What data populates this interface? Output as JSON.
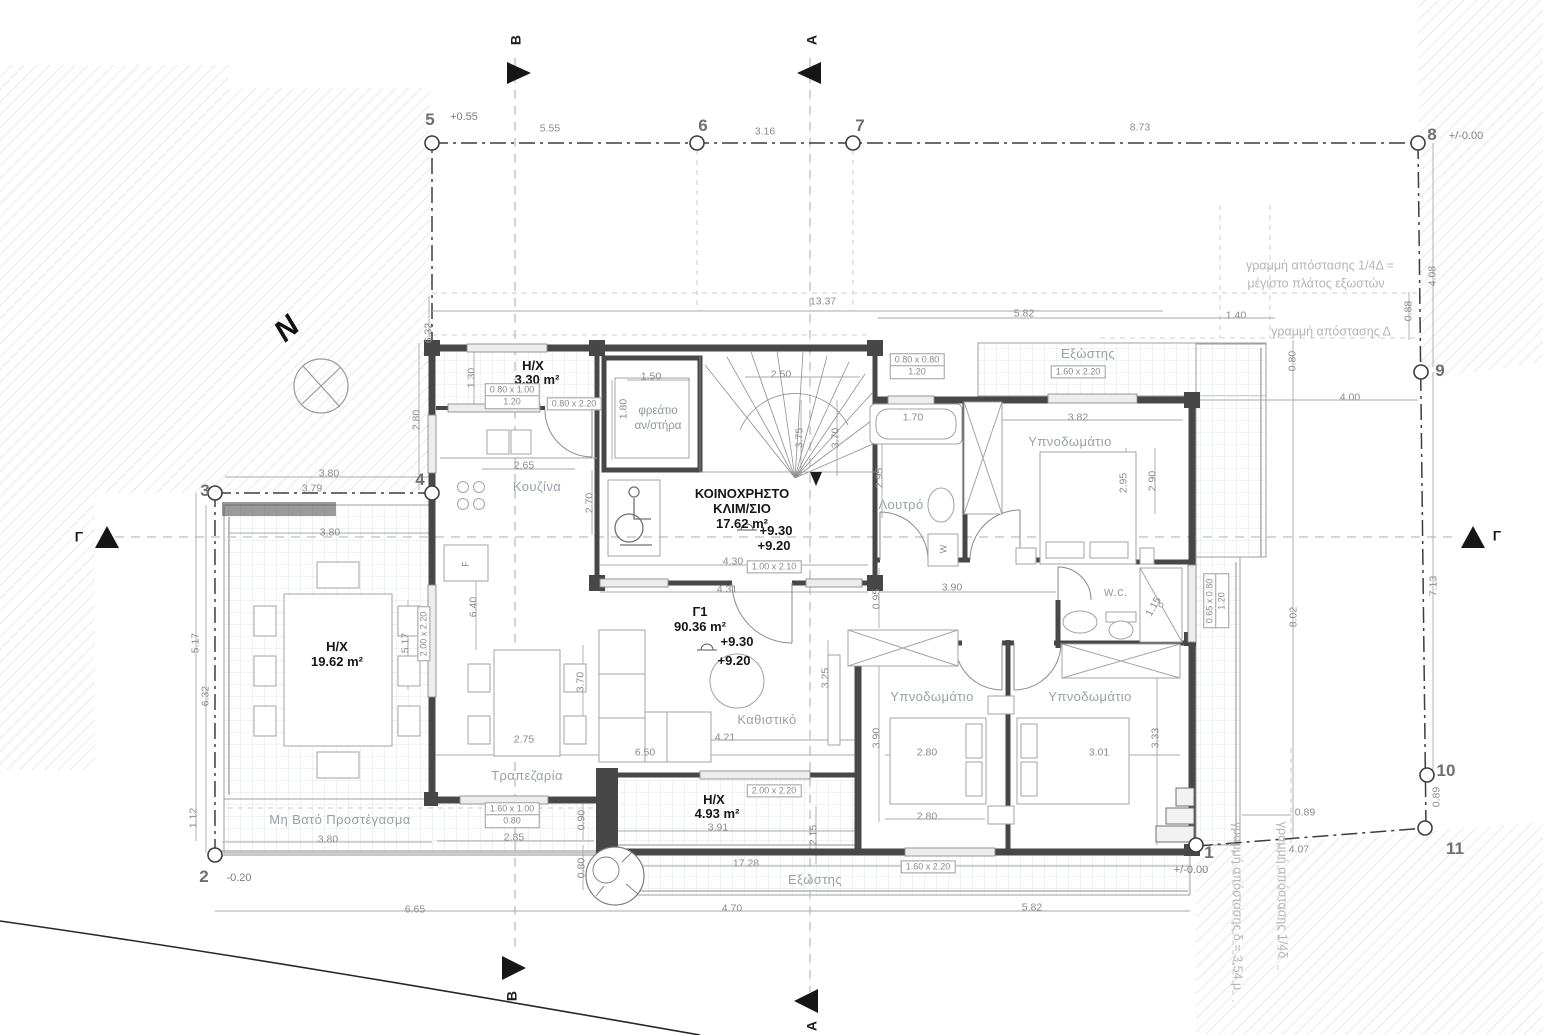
{
  "drawing_type": "floor-plan",
  "labels": [
    {
      "t": "5",
      "x": 430,
      "y": 120,
      "cls": "pt",
      "n": "grid-point-5"
    },
    {
      "t": "6",
      "x": 703,
      "y": 126,
      "cls": "pt",
      "n": "grid-point-6"
    },
    {
      "t": "7",
      "x": 860,
      "y": 126,
      "cls": "pt",
      "n": "grid-point-7"
    },
    {
      "t": "8",
      "x": 1432,
      "y": 135,
      "cls": "pt",
      "n": "grid-point-8"
    },
    {
      "t": "9",
      "x": 1440,
      "y": 371,
      "cls": "pt",
      "n": "grid-point-9"
    },
    {
      "t": "10",
      "x": 1446,
      "y": 771,
      "cls": "pt",
      "n": "grid-point-10"
    },
    {
      "t": "11",
      "x": 1455,
      "y": 849,
      "cls": "pt",
      "n": "grid-point-11"
    },
    {
      "t": "1",
      "x": 1209,
      "y": 853,
      "cls": "pt",
      "n": "grid-point-1"
    },
    {
      "t": "2",
      "x": 204,
      "y": 877,
      "cls": "pt",
      "n": "grid-point-2"
    },
    {
      "t": "3",
      "x": 205,
      "y": 491,
      "cls": "pt",
      "n": "grid-point-3"
    },
    {
      "t": "4",
      "x": 420,
      "y": 480,
      "cls": "pt",
      "n": "grid-point-4"
    },
    {
      "t": "+0.55",
      "x": 464,
      "y": 118,
      "cls": "lvl",
      "n": "level-label"
    },
    {
      "t": "+/-0.00",
      "x": 1466,
      "y": 137,
      "cls": "lvl",
      "n": "level-label"
    },
    {
      "t": "-0.20",
      "x": 239,
      "y": 879,
      "cls": "lvl",
      "n": "level-label"
    },
    {
      "t": "+/-0.00",
      "x": 1191,
      "y": 871,
      "cls": "lvl",
      "n": "level-label"
    },
    {
      "t": "5.55",
      "x": 550,
      "y": 129,
      "cls": "dim"
    },
    {
      "t": "3.16",
      "x": 765,
      "y": 132,
      "cls": "dim"
    },
    {
      "t": "8.73",
      "x": 1140,
      "y": 128,
      "cls": "dim"
    },
    {
      "t": "13.37",
      "x": 823,
      "y": 302,
      "cls": "dim"
    },
    {
      "t": "5.82",
      "x": 1024,
      "y": 314,
      "cls": "dim"
    },
    {
      "t": "1.40",
      "x": 1236,
      "y": 316,
      "cls": "dim"
    },
    {
      "t": "4.08",
      "x": 1433,
      "y": 276,
      "r": -90,
      "cls": "dim"
    },
    {
      "t": "0.88",
      "x": 1409,
      "y": 311,
      "r": -90,
      "cls": "dim"
    },
    {
      "t": "0.80",
      "x": 1293,
      "y": 361,
      "r": -90,
      "cls": "dim"
    },
    {
      "t": "4.00",
      "x": 1350,
      "y": 398,
      "cls": "dim"
    },
    {
      "t": "8.02",
      "x": 1294,
      "y": 617,
      "r": -90,
      "cls": "dim"
    },
    {
      "t": "7.13",
      "x": 1434,
      "y": 586,
      "r": -90,
      "cls": "dim"
    },
    {
      "t": "0.89",
      "x": 1437,
      "y": 797,
      "r": -90,
      "cls": "dim"
    },
    {
      "t": "0.89",
      "x": 1305,
      "y": 813,
      "cls": "dim"
    },
    {
      "t": "4.07",
      "x": 1299,
      "y": 850,
      "cls": "dim"
    },
    {
      "t": "6.32",
      "x": 429,
      "y": 333,
      "r": -90,
      "cls": "dim"
    },
    {
      "t": "2.80",
      "x": 417,
      "y": 420,
      "r": -90,
      "cls": "dim"
    },
    {
      "t": "1.30",
      "x": 472,
      "y": 378,
      "r": -90,
      "cls": "dim"
    },
    {
      "t": "3.80",
      "x": 329,
      "y": 474,
      "cls": "dim"
    },
    {
      "t": "3.79",
      "x": 312,
      "y": 489,
      "cls": "dim"
    },
    {
      "t": "3.80",
      "x": 330,
      "y": 533,
      "cls": "dim"
    },
    {
      "t": "5.17",
      "x": 196,
      "y": 643,
      "r": -90,
      "cls": "dim"
    },
    {
      "t": "6.32",
      "x": 206,
      "y": 696,
      "r": -90,
      "cls": "dim"
    },
    {
      "t": "1.12",
      "x": 194,
      "y": 818,
      "r": -90,
      "cls": "dim"
    },
    {
      "t": "5.17",
      "x": 406,
      "y": 643,
      "r": -90,
      "cls": "dim"
    },
    {
      "t": "6.40",
      "x": 474,
      "y": 607,
      "r": -90,
      "cls": "dim"
    },
    {
      "t": "2.65",
      "x": 524,
      "y": 466,
      "cls": "dim"
    },
    {
      "t": "2.70",
      "x": 590,
      "y": 503,
      "r": -90,
      "cls": "dim"
    },
    {
      "t": "1.50",
      "x": 651,
      "y": 377,
      "cls": "dim"
    },
    {
      "t": "2.50",
      "x": 781,
      "y": 375,
      "cls": "dim"
    },
    {
      "t": "1.80",
      "x": 624,
      "y": 409,
      "r": -90,
      "cls": "dim"
    },
    {
      "t": "3.75",
      "x": 800,
      "y": 438,
      "r": -90,
      "cls": "dim"
    },
    {
      "t": "3.70",
      "x": 836,
      "y": 438,
      "r": -90,
      "cls": "dim"
    },
    {
      "t": "4.30",
      "x": 733,
      "y": 562,
      "cls": "dim"
    },
    {
      "t": "4.31",
      "x": 727,
      "y": 590,
      "cls": "dim"
    },
    {
      "t": "1.70",
      "x": 913,
      "y": 418,
      "cls": "dim"
    },
    {
      "t": "2.95",
      "x": 880,
      "y": 478,
      "r": -90,
      "cls": "dim"
    },
    {
      "t": "3.82",
      "x": 1078,
      "y": 418,
      "cls": "dim"
    },
    {
      "t": "2.95",
      "x": 1124,
      "y": 483,
      "r": -90,
      "cls": "dim"
    },
    {
      "t": "2.90",
      "x": 1153,
      "y": 481,
      "r": -90,
      "cls": "dim"
    },
    {
      "t": "0.95",
      "x": 877,
      "y": 599,
      "r": -90,
      "cls": "dim"
    },
    {
      "t": "3.90",
      "x": 952,
      "y": 588,
      "cls": "dim"
    },
    {
      "t": "1.15",
      "x": 1154,
      "y": 607,
      "r": -60,
      "cls": "dim"
    },
    {
      "t": "2.75",
      "x": 524,
      "y": 740,
      "cls": "dim"
    },
    {
      "t": "3.70",
      "x": 581,
      "y": 682,
      "r": -90,
      "cls": "dim"
    },
    {
      "t": "6.50",
      "x": 645,
      "y": 753,
      "cls": "dim"
    },
    {
      "t": "4.21",
      "x": 725,
      "y": 738,
      "cls": "dim"
    },
    {
      "t": "3.25",
      "x": 826,
      "y": 678,
      "r": -90,
      "cls": "dim"
    },
    {
      "t": "3.90",
      "x": 877,
      "y": 738,
      "r": -90,
      "cls": "dim"
    },
    {
      "t": "2.80",
      "x": 927,
      "y": 753,
      "cls": "dim"
    },
    {
      "t": "3.01",
      "x": 1099,
      "y": 753,
      "cls": "dim"
    },
    {
      "t": "3.33",
      "x": 1156,
      "y": 738,
      "r": -90,
      "cls": "dim"
    },
    {
      "t": "2.80",
      "x": 927,
      "y": 817,
      "cls": "dim"
    },
    {
      "t": "2.85",
      "x": 514,
      "y": 838,
      "cls": "dim"
    },
    {
      "t": "0.90",
      "x": 582,
      "y": 820,
      "r": -90,
      "cls": "dim"
    },
    {
      "t": "0.80",
      "x": 582,
      "y": 868,
      "r": -90,
      "cls": "dim"
    },
    {
      "t": "3.91",
      "x": 718,
      "y": 828,
      "cls": "dim"
    },
    {
      "t": "2.15",
      "x": 814,
      "y": 835,
      "r": -90,
      "cls": "dim"
    },
    {
      "t": "17.28",
      "x": 746,
      "y": 864,
      "cls": "dim"
    },
    {
      "t": "3.80",
      "x": 328,
      "y": 840,
      "cls": "dim"
    },
    {
      "t": "6.65",
      "x": 415,
      "y": 910,
      "cls": "dim"
    },
    {
      "t": "4.70",
      "x": 732,
      "y": 909,
      "cls": "dim"
    },
    {
      "t": "5.82",
      "x": 1032,
      "y": 908,
      "cls": "dim"
    },
    {
      "t": "Κουζίνα",
      "x": 537,
      "y": 487,
      "cls": "room",
      "n": "room-label-kitchen"
    },
    {
      "t": "Λουτρό",
      "x": 901,
      "y": 505,
      "cls": "room",
      "n": "room-label-bathroom"
    },
    {
      "t": "Υπνοδωμάτιο",
      "x": 1070,
      "y": 442,
      "cls": "room",
      "n": "room-label-bedroom-1"
    },
    {
      "t": "Καθιστικό",
      "x": 767,
      "y": 720,
      "cls": "room",
      "n": "room-label-living"
    },
    {
      "t": "Τραπεζαρία",
      "x": 527,
      "y": 776,
      "cls": "room",
      "n": "room-label-dining"
    },
    {
      "t": "Υπνοδωμάτιο",
      "x": 932,
      "y": 697,
      "cls": "room",
      "n": "room-label-bedroom-2"
    },
    {
      "t": "Υπνοδωμάτιο",
      "x": 1090,
      "y": 697,
      "cls": "room",
      "n": "room-label-bedroom-3"
    },
    {
      "t": "w.c.",
      "x": 1116,
      "y": 592,
      "cls": "room",
      "n": "room-label-wc"
    },
    {
      "t": "Εξώστης",
      "x": 1088,
      "y": 354,
      "cls": "room",
      "n": "room-label-balcony-top"
    },
    {
      "t": "Εξώστης",
      "x": 815,
      "y": 880,
      "cls": "room",
      "n": "room-label-balcony-bottom"
    },
    {
      "t": "Μη Βατό Προστέγασμα",
      "x": 340,
      "y": 820,
      "cls": "room",
      "n": "room-label-canopy"
    },
    {
      "t": "φρεάτιο",
      "x": 658,
      "y": 411,
      "cls": "roomsm",
      "n": "room-label-elevator-shaft"
    },
    {
      "t": "αν/στήρα",
      "x": 658,
      "y": 426,
      "cls": "roomsm",
      "n": "room-label-elevator-shaft"
    },
    {
      "t": "H/X",
      "x": 533,
      "y": 366,
      "cls": "bold",
      "n": "area-label"
    },
    {
      "t": "3.30 m²",
      "x": 537,
      "y": 380,
      "cls": "bold",
      "n": "area-label"
    },
    {
      "t": "H/X",
      "x": 337,
      "y": 647,
      "cls": "bold",
      "n": "area-label"
    },
    {
      "t": "19.62 m²",
      "x": 337,
      "y": 662,
      "cls": "bold",
      "n": "area-label"
    },
    {
      "t": "ΚΟΙΝΟΧΡΗΣΤΟ",
      "x": 742,
      "y": 494,
      "cls": "bold",
      "n": "area-label-common-stair"
    },
    {
      "t": "ΚΛΙΜ/ΣΙΟ",
      "x": 742,
      "y": 509,
      "cls": "bold",
      "n": "area-label-common-stair"
    },
    {
      "t": "17.62 m²",
      "x": 742,
      "y": 524,
      "cls": "bold",
      "n": "area-label-common-stair"
    },
    {
      "t": "Γ1",
      "x": 700,
      "y": 612,
      "cls": "bold",
      "n": "area-label-apartment"
    },
    {
      "t": "90.36 m²",
      "x": 700,
      "y": 627,
      "cls": "bold",
      "n": "area-label-apartment"
    },
    {
      "t": "H/X",
      "x": 714,
      "y": 800,
      "cls": "bold",
      "n": "area-label"
    },
    {
      "t": "4.93 m²",
      "x": 717,
      "y": 814,
      "cls": "bold",
      "n": "area-label"
    },
    {
      "t": "+9.30",
      "x": 776,
      "y": 531,
      "cls": "bold",
      "n": "level-label"
    },
    {
      "t": "+9.20",
      "x": 774,
      "y": 546,
      "cls": "bold",
      "n": "level-label"
    },
    {
      "t": "+9.30",
      "x": 737,
      "y": 642,
      "cls": "bold",
      "n": "level-label"
    },
    {
      "t": "+9.20",
      "x": 734,
      "y": 661,
      "cls": "bold",
      "n": "level-label"
    },
    {
      "t": "γραμμή απόστασης 1/4Δ =",
      "x": 1320,
      "y": 266,
      "cls": "setb",
      "n": "setback-note"
    },
    {
      "t": "μέγιστο πλάτος εξωστών",
      "x": 1316,
      "y": 284,
      "cls": "setb",
      "n": "setback-note"
    },
    {
      "t": "γραμμή απόστασης Δ",
      "x": 1331,
      "y": 332,
      "cls": "setb",
      "n": "setback-note"
    },
    {
      "t": "γραμμή απόστασης δ = 3,54 μ",
      "x": 1237,
      "y": 906,
      "r": 90,
      "cls": "setb",
      "n": "setback-note"
    },
    {
      "t": "γραμμή απόστασης 1/4δ",
      "x": 1282,
      "y": 890,
      "r": 90,
      "cls": "setb",
      "n": "setback-note"
    },
    {
      "t": "B",
      "x": 516,
      "y": 40,
      "r": -90,
      "cls": "sec",
      "n": "section-marker-b-top"
    },
    {
      "t": "A",
      "x": 812,
      "y": 40,
      "r": -90,
      "cls": "sec",
      "n": "section-marker-a-top"
    },
    {
      "t": "Γ",
      "x": 79,
      "y": 537,
      "cls": "sec",
      "n": "section-marker-g-left"
    },
    {
      "t": "Γ",
      "x": 1497,
      "y": 536,
      "cls": "sec",
      "n": "section-marker-g-right"
    },
    {
      "t": "B",
      "x": 512,
      "y": 996,
      "r": -90,
      "cls": "sec",
      "n": "section-marker-b-bottom"
    },
    {
      "t": "A",
      "x": 812,
      "y": 1026,
      "r": -90,
      "cls": "sec",
      "n": "section-marker-a-bottom"
    },
    {
      "t": "N",
      "x": 287,
      "y": 329,
      "r": -42,
      "cls": "north",
      "n": "north-letter"
    },
    {
      "t": "W",
      "x": 944,
      "y": 549,
      "r": -90,
      "cls": "tiny",
      "n": "washer-label"
    },
    {
      "t": "F",
      "x": 466,
      "y": 564,
      "r": -90,
      "cls": "tiny",
      "n": "fridge-label"
    }
  ],
  "boxes": [
    {
      "l1": "0.80 x 1.00",
      "l2": "1.20",
      "x": 512,
      "y": 396
    },
    {
      "l1": "0.80 x 2.20",
      "x": 574,
      "y": 404
    },
    {
      "l1": "0.80 x 0.80",
      "l2": "1.20",
      "x": 917,
      "y": 366
    },
    {
      "l1": "1.60 x 2.20",
      "x": 1078,
      "y": 372
    },
    {
      "l1": "1.00 x 2.10",
      "x": 774,
      "y": 567
    },
    {
      "l1": "2.00 x 2.20",
      "x": 424,
      "y": 634,
      "r": -90
    },
    {
      "l1": "0.65 x 0.80",
      "l2": "1.20",
      "x": 1216,
      "y": 601,
      "r": -90
    },
    {
      "l1": "1.60 x 1.00",
      "l2": "0.80",
      "x": 512,
      "y": 815
    },
    {
      "l1": "2.00 x 2.20",
      "x": 774,
      "y": 791
    },
    {
      "l1": "1.60 x 2.20",
      "x": 928,
      "y": 867
    }
  ]
}
